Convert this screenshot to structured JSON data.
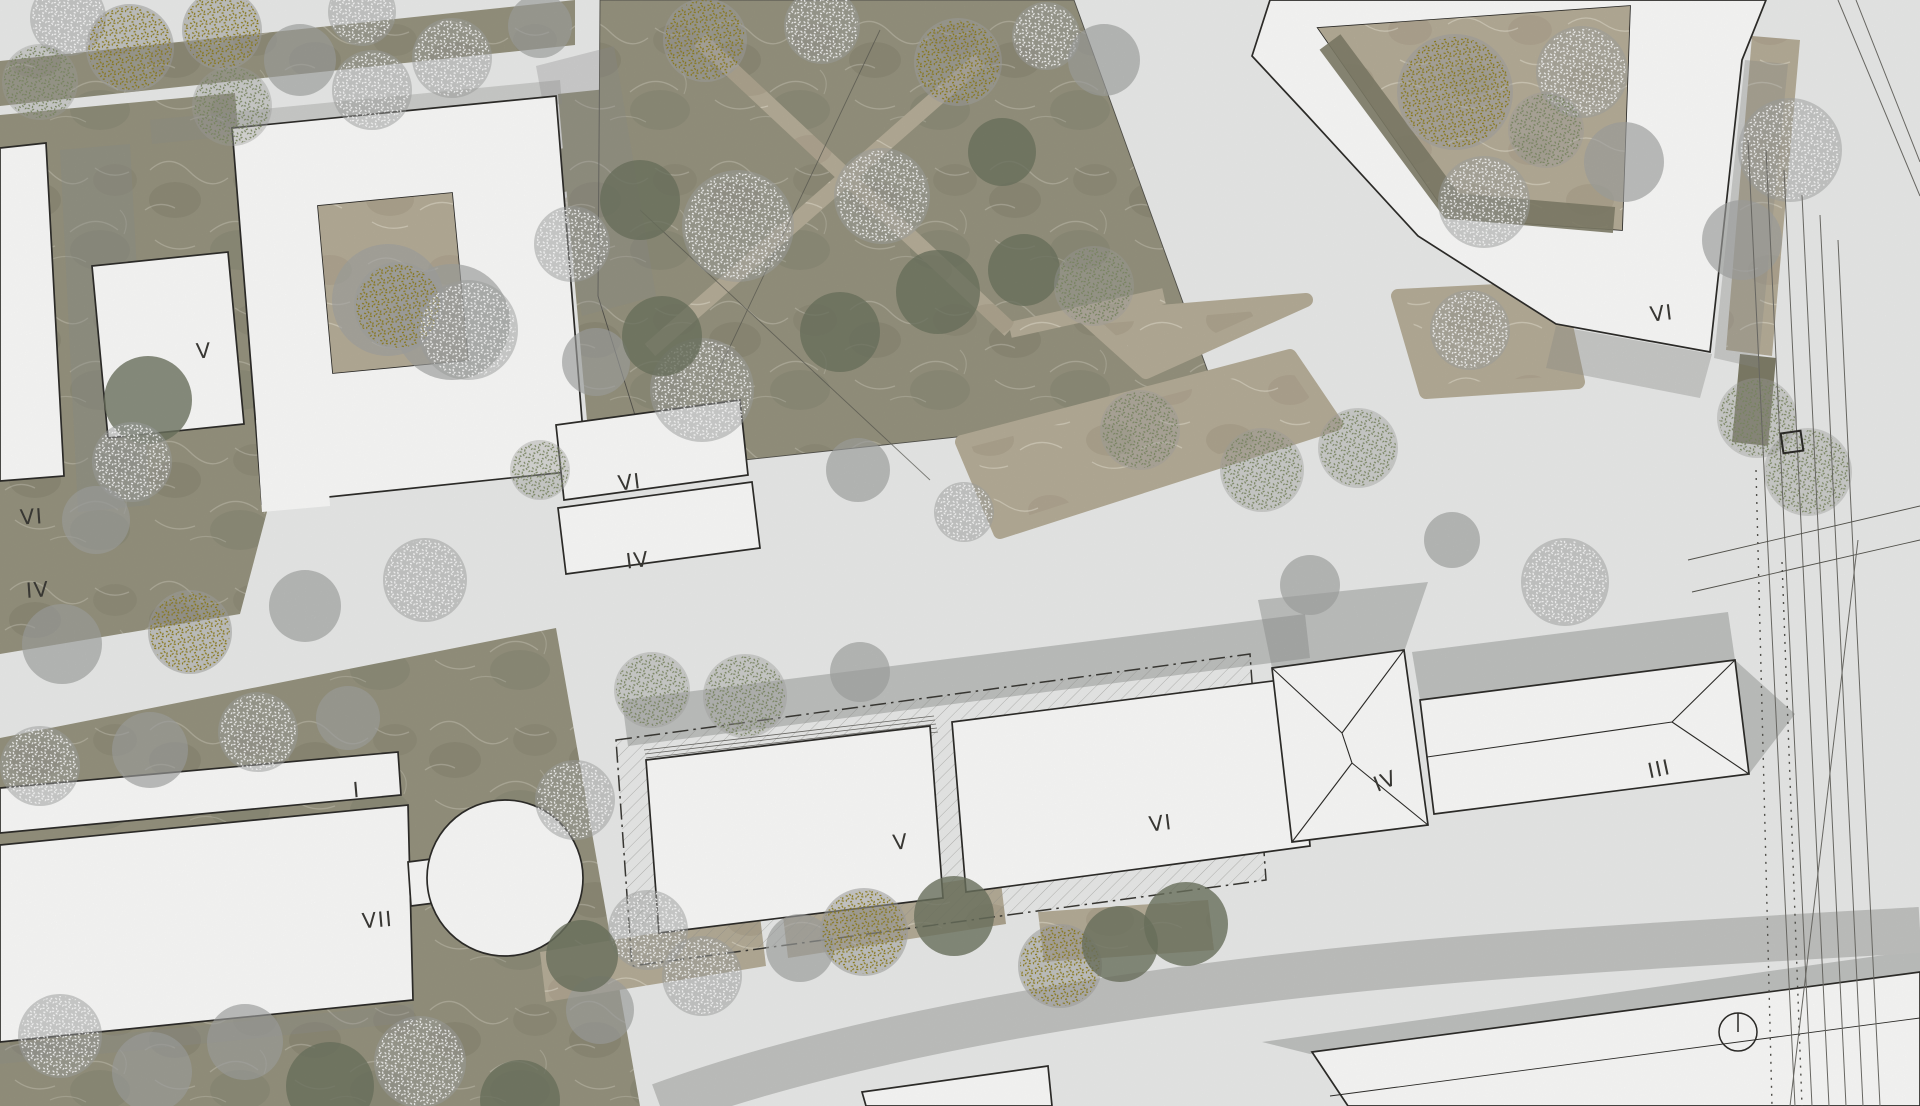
{
  "colors": {
    "paper": "#ecedec",
    "building": "#fdfdfc",
    "outline": "#2e2d2a",
    "label": "#3c3b37",
    "grass": "#97947f",
    "grass-dark": "#7f7d68",
    "bed": "#b7ae99",
    "shadow": "#8e908d",
    "road-band": "#c3c4c2",
    "tree-gray": "#a2a3a1",
    "tree-dark": "#6e7460",
    "tree-white": "#ffffff",
    "tree-yellow": "#8f7d1a",
    "tree-green": "#7d8a64"
  },
  "map": {
    "labels": [
      {
        "text": "V"
      },
      {
        "text": "VI"
      },
      {
        "text": "IV"
      },
      {
        "text": "VI"
      },
      {
        "text": "IV"
      },
      {
        "text": "I"
      },
      {
        "text": "VII"
      },
      {
        "text": "V"
      },
      {
        "text": "VI"
      },
      {
        "text": "IV"
      },
      {
        "text": "III"
      },
      {
        "text": "VI"
      }
    ],
    "trees": [
      {
        "x": 68,
        "y": 18,
        "r": 38,
        "t": "white"
      },
      {
        "x": 130,
        "y": 48,
        "r": 44,
        "t": "yellow"
      },
      {
        "x": 222,
        "y": 30,
        "r": 40,
        "t": "yellow"
      },
      {
        "x": 40,
        "y": 82,
        "r": 38,
        "t": "green"
      },
      {
        "x": 232,
        "y": 106,
        "r": 40,
        "t": "green"
      },
      {
        "x": 300,
        "y": 60,
        "r": 36,
        "t": "gray"
      },
      {
        "x": 362,
        "y": 12,
        "r": 34,
        "t": "white"
      },
      {
        "x": 372,
        "y": 90,
        "r": 40,
        "t": "white"
      },
      {
        "x": 452,
        "y": 58,
        "r": 40,
        "t": "white"
      },
      {
        "x": 540,
        "y": 26,
        "r": 32,
        "t": "gray"
      },
      {
        "x": 62,
        "y": 644,
        "r": 40,
        "t": "gray"
      },
      {
        "x": 190,
        "y": 632,
        "r": 42,
        "t": "yellow"
      },
      {
        "x": 305,
        "y": 606,
        "r": 36,
        "t": "gray"
      },
      {
        "x": 425,
        "y": 580,
        "r": 42,
        "t": "white"
      },
      {
        "x": 540,
        "y": 470,
        "r": 30,
        "t": "green"
      },
      {
        "x": 572,
        "y": 244,
        "r": 38,
        "t": "white"
      },
      {
        "x": 596,
        "y": 362,
        "r": 34,
        "t": "gray"
      },
      {
        "x": 148,
        "y": 400,
        "r": 44,
        "t": "dark"
      },
      {
        "x": 132,
        "y": 462,
        "r": 40,
        "t": "white"
      },
      {
        "x": 96,
        "y": 520,
        "r": 34,
        "t": "gray"
      },
      {
        "x": 388,
        "y": 300,
        "r": 56,
        "t": "gray"
      },
      {
        "x": 452,
        "y": 322,
        "r": 58,
        "t": "gray"
      },
      {
        "x": 398,
        "y": 306,
        "r": 44,
        "t": "yellow"
      },
      {
        "x": 468,
        "y": 330,
        "r": 50,
        "t": "white"
      },
      {
        "x": 705,
        "y": 40,
        "r": 42,
        "t": "yellow"
      },
      {
        "x": 822,
        "y": 26,
        "r": 38,
        "t": "white"
      },
      {
        "x": 958,
        "y": 62,
        "r": 44,
        "t": "yellow"
      },
      {
        "x": 1046,
        "y": 36,
        "r": 34,
        "t": "white"
      },
      {
        "x": 640,
        "y": 200,
        "r": 40,
        "t": "dark"
      },
      {
        "x": 738,
        "y": 226,
        "r": 56,
        "t": "white"
      },
      {
        "x": 882,
        "y": 196,
        "r": 48,
        "t": "white"
      },
      {
        "x": 702,
        "y": 390,
        "r": 52,
        "t": "white"
      },
      {
        "x": 662,
        "y": 336,
        "r": 40,
        "t": "dark"
      },
      {
        "x": 840,
        "y": 332,
        "r": 40,
        "t": "dark"
      },
      {
        "x": 938,
        "y": 292,
        "r": 42,
        "t": "dark"
      },
      {
        "x": 1024,
        "y": 270,
        "r": 36,
        "t": "dark"
      },
      {
        "x": 1002,
        "y": 152,
        "r": 34,
        "t": "dark"
      },
      {
        "x": 1094,
        "y": 286,
        "r": 40,
        "t": "green"
      },
      {
        "x": 858,
        "y": 470,
        "r": 32,
        "t": "gray"
      },
      {
        "x": 964,
        "y": 512,
        "r": 30,
        "t": "white"
      },
      {
        "x": 1104,
        "y": 60,
        "r": 36,
        "t": "gray"
      },
      {
        "x": 40,
        "y": 766,
        "r": 40,
        "t": "white"
      },
      {
        "x": 150,
        "y": 750,
        "r": 38,
        "t": "gray"
      },
      {
        "x": 258,
        "y": 732,
        "r": 40,
        "t": "white"
      },
      {
        "x": 348,
        "y": 718,
        "r": 32,
        "t": "gray"
      },
      {
        "x": 575,
        "y": 800,
        "r": 40,
        "t": "white"
      },
      {
        "x": 648,
        "y": 930,
        "r": 40,
        "t": "white"
      },
      {
        "x": 420,
        "y": 1062,
        "r": 46,
        "t": "white"
      },
      {
        "x": 330,
        "y": 1086,
        "r": 44,
        "t": "dark"
      },
      {
        "x": 245,
        "y": 1042,
        "r": 38,
        "t": "gray"
      },
      {
        "x": 60,
        "y": 1036,
        "r": 42,
        "t": "white"
      },
      {
        "x": 152,
        "y": 1072,
        "r": 40,
        "t": "gray"
      },
      {
        "x": 520,
        "y": 1100,
        "r": 40,
        "t": "dark"
      },
      {
        "x": 600,
        "y": 1010,
        "r": 34,
        "t": "gray"
      },
      {
        "x": 652,
        "y": 690,
        "r": 38,
        "t": "green"
      },
      {
        "x": 745,
        "y": 696,
        "r": 42,
        "t": "green"
      },
      {
        "x": 860,
        "y": 672,
        "r": 30,
        "t": "gray"
      },
      {
        "x": 582,
        "y": 956,
        "r": 36,
        "t": "dark"
      },
      {
        "x": 702,
        "y": 976,
        "r": 40,
        "t": "white"
      },
      {
        "x": 800,
        "y": 948,
        "r": 34,
        "t": "gray"
      },
      {
        "x": 864,
        "y": 932,
        "r": 44,
        "t": "yellow"
      },
      {
        "x": 954,
        "y": 916,
        "r": 40,
        "t": "dark"
      },
      {
        "x": 1060,
        "y": 966,
        "r": 42,
        "t": "yellow"
      },
      {
        "x": 1120,
        "y": 944,
        "r": 38,
        "t": "dark"
      },
      {
        "x": 1186,
        "y": 924,
        "r": 42,
        "t": "dark"
      },
      {
        "x": 1140,
        "y": 430,
        "r": 40,
        "t": "green"
      },
      {
        "x": 1262,
        "y": 470,
        "r": 42,
        "t": "green"
      },
      {
        "x": 1358,
        "y": 448,
        "r": 40,
        "t": "green"
      },
      {
        "x": 1470,
        "y": 330,
        "r": 40,
        "t": "white"
      },
      {
        "x": 1565,
        "y": 582,
        "r": 44,
        "t": "white"
      },
      {
        "x": 1310,
        "y": 585,
        "r": 30,
        "t": "gray"
      },
      {
        "x": 1452,
        "y": 540,
        "r": 28,
        "t": "gray"
      },
      {
        "x": 1757,
        "y": 418,
        "r": 40,
        "t": "green"
      },
      {
        "x": 1808,
        "y": 472,
        "r": 44,
        "t": "green"
      },
      {
        "x": 1790,
        "y": 150,
        "r": 52,
        "t": "white"
      },
      {
        "x": 1742,
        "y": 240,
        "r": 40,
        "t": "gray"
      },
      {
        "x": 1455,
        "y": 92,
        "r": 58,
        "t": "yellow"
      },
      {
        "x": 1582,
        "y": 72,
        "r": 46,
        "t": "white"
      },
      {
        "x": 1546,
        "y": 130,
        "r": 38,
        "t": "green"
      },
      {
        "x": 1484,
        "y": 202,
        "r": 46,
        "t": "white"
      },
      {
        "x": 1624,
        "y": 162,
        "r": 40,
        "t": "gray"
      }
    ]
  }
}
